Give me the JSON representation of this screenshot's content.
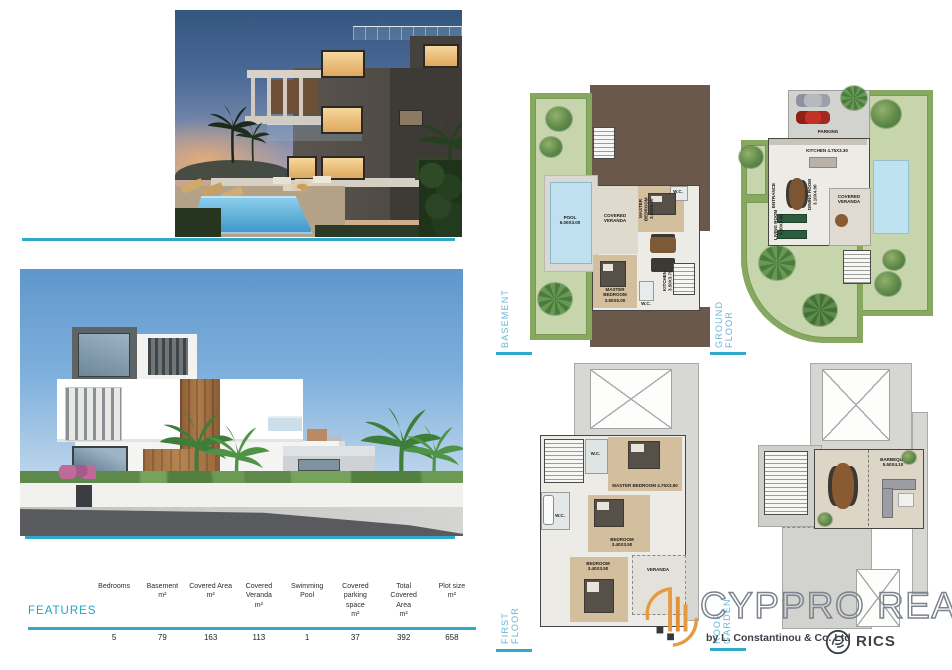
{
  "accent": {
    "teal": "#2FA8C9",
    "plan_label_blue": "#67B6D8",
    "logo_orange": "#E59A3F",
    "logo_gray": "#7D838C"
  },
  "features": {
    "label": "FEATURES",
    "columns": [
      {
        "header": "Bedrooms",
        "value": "5"
      },
      {
        "header": "Basement\nm²",
        "value": "79"
      },
      {
        "header": "Covered Area\nm²",
        "value": "163"
      },
      {
        "header": "Covered\nVeranda\nm²",
        "value": "113"
      },
      {
        "header": "Swimming\nPool",
        "value": "1"
      },
      {
        "header": "Covered\nparking\nspace\nm²",
        "value": "37"
      },
      {
        "header": "Total\nCovered\nArea\nm²",
        "value": "392"
      },
      {
        "header": "Plot size\nm²",
        "value": "658"
      }
    ]
  },
  "plans": {
    "basement": {
      "label": "BASEMENT",
      "pool": "POOL\n6.00X3.00",
      "covered_veranda": "COVERED\nVERANDA",
      "master_bedroom_top": "MASTER BEDROOM\n3.60X5.00",
      "wc_top": "W.C.",
      "master_bedroom_bottom": "MASTER\nBEDROOM\n3.50X5.00",
      "wc_bottom": "W.C.",
      "kitchen": "KITCHEN\n3.50X3.75"
    },
    "ground": {
      "label": "GROUND FLOOR",
      "parking": "PARKING",
      "kitchen": "KITCHEN 4.75X3.30",
      "dining_room": "DINING ROOM\n3.10X4.00",
      "entrance": "ENTRANCE",
      "living_room": "LIVING ROOM\n4.30X4.60",
      "covered_veranda": "COVERED\nVERANDA"
    },
    "first": {
      "label": "FIRST FLOOR",
      "wc": "W.C.",
      "master_bedroom": "MASTER BEDROOM 4.75X3.90",
      "bedroom_mid": "BEDROOM\n3.40X3.50",
      "bedroom_bottom": "BEDROOM\n3.40X3.50",
      "veranda": "VERANDA"
    },
    "roof": {
      "label": "ROOF GARDEN",
      "barbeque": "BARBEQUE\n5.50X4.10"
    }
  },
  "branding": {
    "company": "CYPPRO REALTY",
    "byline": "by L. Constantinou & Co. Ltd",
    "rics": "RICS"
  }
}
